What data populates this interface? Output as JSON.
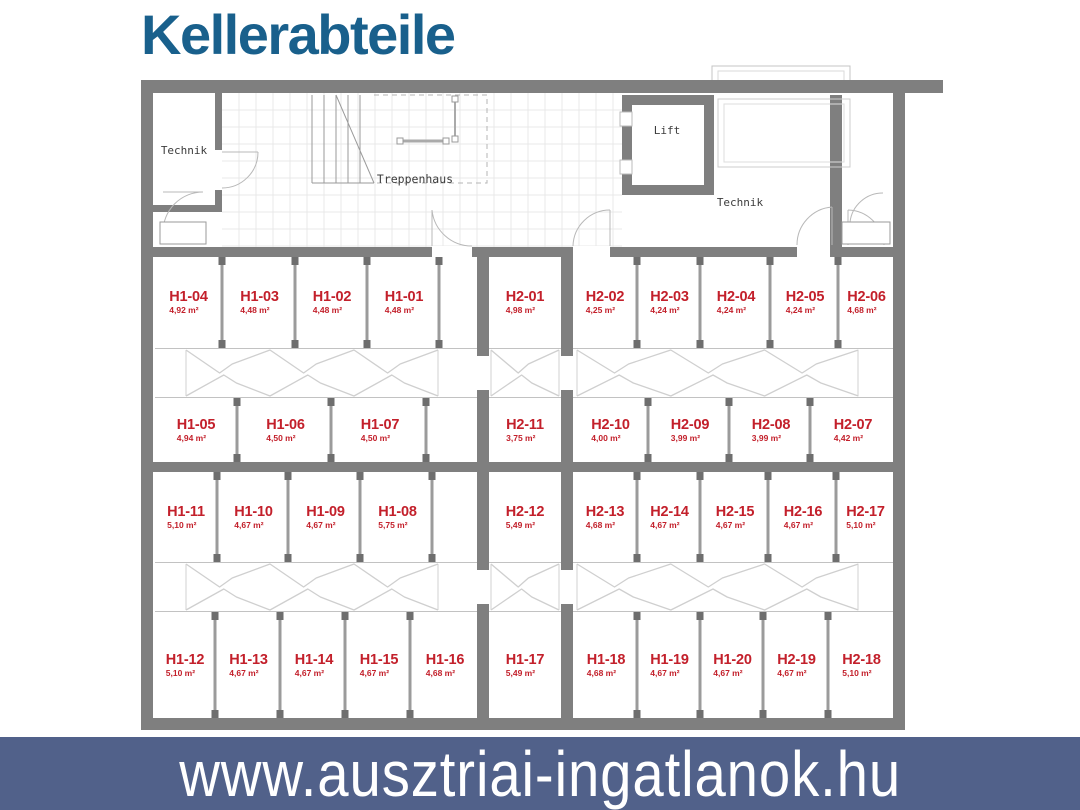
{
  "title": "Kellerabteile",
  "banner": {
    "text": "www.ausztriai-ingatlanok.hu"
  },
  "colors": {
    "title_blue": "#19608c",
    "unit_red": "#c3202b",
    "banner_bg": "#51618a",
    "banner_text": "#ffffff",
    "wall_gray": "#7f7f7f"
  },
  "plan": {
    "rooms": [
      {
        "name": "Technik"
      },
      {
        "name": "Treppenhaus"
      },
      {
        "name": "Lift"
      },
      {
        "name": "Technik"
      }
    ],
    "units": [
      {
        "id": "H1-04",
        "area": "4,92 m²"
      },
      {
        "id": "H1-03",
        "area": "4,48 m²"
      },
      {
        "id": "H1-02",
        "area": "4,48 m²"
      },
      {
        "id": "H1-01",
        "area": "4,48 m²"
      },
      {
        "id": "H2-01",
        "area": "4,98 m²"
      },
      {
        "id": "H2-02",
        "area": "4,25 m²"
      },
      {
        "id": "H2-03",
        "area": "4,24 m²"
      },
      {
        "id": "H2-04",
        "area": "4,24 m²"
      },
      {
        "id": "H2-05",
        "area": "4,24 m²"
      },
      {
        "id": "H2-06",
        "area": "4,68 m²"
      },
      {
        "id": "H1-05",
        "area": "4,94 m²"
      },
      {
        "id": "H1-06",
        "area": "4,50 m²"
      },
      {
        "id": "H1-07",
        "area": "4,50 m²"
      },
      {
        "id": "H2-11",
        "area": "3,75 m²"
      },
      {
        "id": "H2-10",
        "area": "4,00 m²"
      },
      {
        "id": "H2-09",
        "area": "3,99 m²"
      },
      {
        "id": "H2-08",
        "area": "3,99 m²"
      },
      {
        "id": "H2-07",
        "area": "4,42 m²"
      },
      {
        "id": "H1-11",
        "area": "5,10 m²"
      },
      {
        "id": "H1-10",
        "area": "4,67 m²"
      },
      {
        "id": "H1-09",
        "area": "4,67 m²"
      },
      {
        "id": "H1-08",
        "area": "5,75 m²"
      },
      {
        "id": "H2-12",
        "area": "5,49 m²"
      },
      {
        "id": "H2-13",
        "area": "4,68 m²"
      },
      {
        "id": "H2-14",
        "area": "4,67 m²"
      },
      {
        "id": "H2-15",
        "area": "4,67 m²"
      },
      {
        "id": "H2-16",
        "area": "4,67 m²"
      },
      {
        "id": "H2-17",
        "area": "5,10 m²"
      },
      {
        "id": "H1-12",
        "area": "5,10 m²"
      },
      {
        "id": "H1-13",
        "area": "4,67 m²"
      },
      {
        "id": "H1-14",
        "area": "4,67 m²"
      },
      {
        "id": "H1-15",
        "area": "4,67 m²"
      },
      {
        "id": "H1-16",
        "area": "4,68 m²"
      },
      {
        "id": "H1-17",
        "area": "5,49 m²"
      },
      {
        "id": "H1-18",
        "area": "4,68 m²"
      },
      {
        "id": "H1-19",
        "area": "4,67 m²"
      },
      {
        "id": "H1-20",
        "area": "4,67 m²"
      },
      {
        "id": "H2-19",
        "area": "4,67 m²"
      },
      {
        "id": "H2-18",
        "area": "5,10 m²"
      }
    ]
  }
}
